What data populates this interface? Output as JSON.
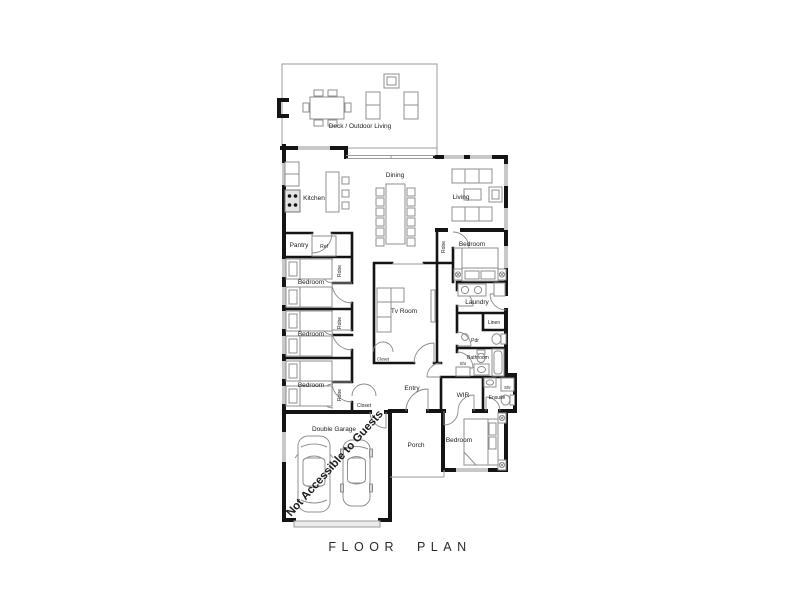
{
  "title": "FLOOR PLAN",
  "annotation": {
    "text": "Not Accessible to Guests",
    "color": "#bf3a35"
  },
  "rooms": {
    "deck": "Deck / Outdoor Living",
    "kitchen": "Kitchen",
    "dining": "Dining",
    "living": "Living",
    "pantry": "Pantry",
    "ref": "Ref",
    "bedroom": "Bedroom",
    "tv_room": "Tv Room",
    "robe": "Robe",
    "closet": "Closet",
    "laundry": "Laundry",
    "linen": "Linen",
    "pdr": "Pdr",
    "bathroom": "Bathroom",
    "shr": "Shr",
    "wir": "WIR",
    "ensuite": "Ensuite",
    "entry": "Entry",
    "porch": "Porch",
    "garage": "Double Garage"
  }
}
